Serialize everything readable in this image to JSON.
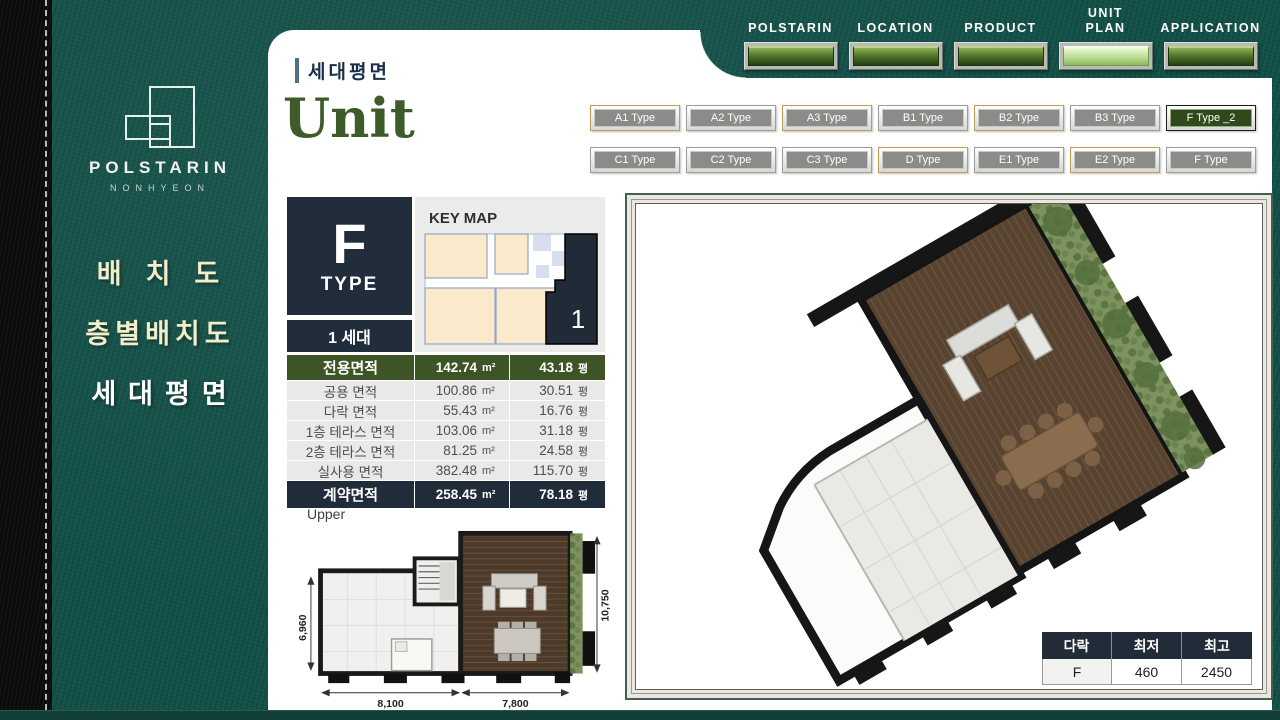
{
  "nav": {
    "items": [
      {
        "label": "POLSTARIN"
      },
      {
        "label": "LOCATION"
      },
      {
        "label": "PRODUCT"
      },
      {
        "label": "UNIT PLAN"
      },
      {
        "label": "APPLICATION"
      }
    ],
    "active": "UNIT PLAN"
  },
  "sidebar": {
    "brand": "POLSTARIN",
    "brand_sub": "NONHYEON",
    "menu": [
      {
        "label": "배치도"
      },
      {
        "label": "층별배치도"
      },
      {
        "label": "세대평면"
      }
    ],
    "active_menu": "세대평면"
  },
  "header": {
    "breadcrumb": "세대평면",
    "title": "Unit"
  },
  "types": {
    "row1": [
      "A1 Type",
      "A2 Type",
      "A3 Type",
      "B1 Type",
      "B2 Type",
      "B3 Type",
      "F Type _2"
    ],
    "row2": [
      "C1 Type",
      "C2 Type",
      "C3 Type",
      "D Type",
      "E1 Type",
      "E2 Type",
      "F Type"
    ],
    "active": "F Type _2"
  },
  "unit": {
    "letter": "F",
    "type_word": "TYPE",
    "household": "1 세대",
    "keymap_title": "KEY MAP",
    "keymap_unit": "1"
  },
  "area_table": {
    "sqm_unit": "m²",
    "pyeong_unit": "평",
    "rows": [
      {
        "label": "전용면적",
        "sqm": "142.74",
        "pyeong": "43.18"
      },
      {
        "label": "공용 면적",
        "sqm": "100.86",
        "pyeong": "30.51"
      },
      {
        "label": "다락 면적",
        "sqm": "55.43",
        "pyeong": "16.76"
      },
      {
        "label": "1층 테라스 면적",
        "sqm": "103.06",
        "pyeong": "31.18"
      },
      {
        "label": "2층 테라스 면적",
        "sqm": "81.25",
        "pyeong": "24.58"
      },
      {
        "label": "실사용 면적",
        "sqm": "382.48",
        "pyeong": "115.70"
      },
      {
        "label": "계약면적",
        "sqm": "258.45",
        "pyeong": "78.18"
      }
    ]
  },
  "floor_plan": {
    "label": "Upper",
    "dims": {
      "left": "6,960",
      "right": "10,750",
      "bottom_left": "8,100",
      "bottom_right": "7,800"
    }
  },
  "attic_table": {
    "headers": [
      "다락",
      "최저",
      "최고"
    ],
    "row": [
      "F",
      "460",
      "2450"
    ]
  },
  "colors": {
    "teal_bg": "#135149",
    "accent_green": "#3d5c29",
    "navy": "#222d3b",
    "table_green": "#3c5426",
    "active_nav_button": "#bfe095",
    "menu_cream": "#f3edca"
  }
}
